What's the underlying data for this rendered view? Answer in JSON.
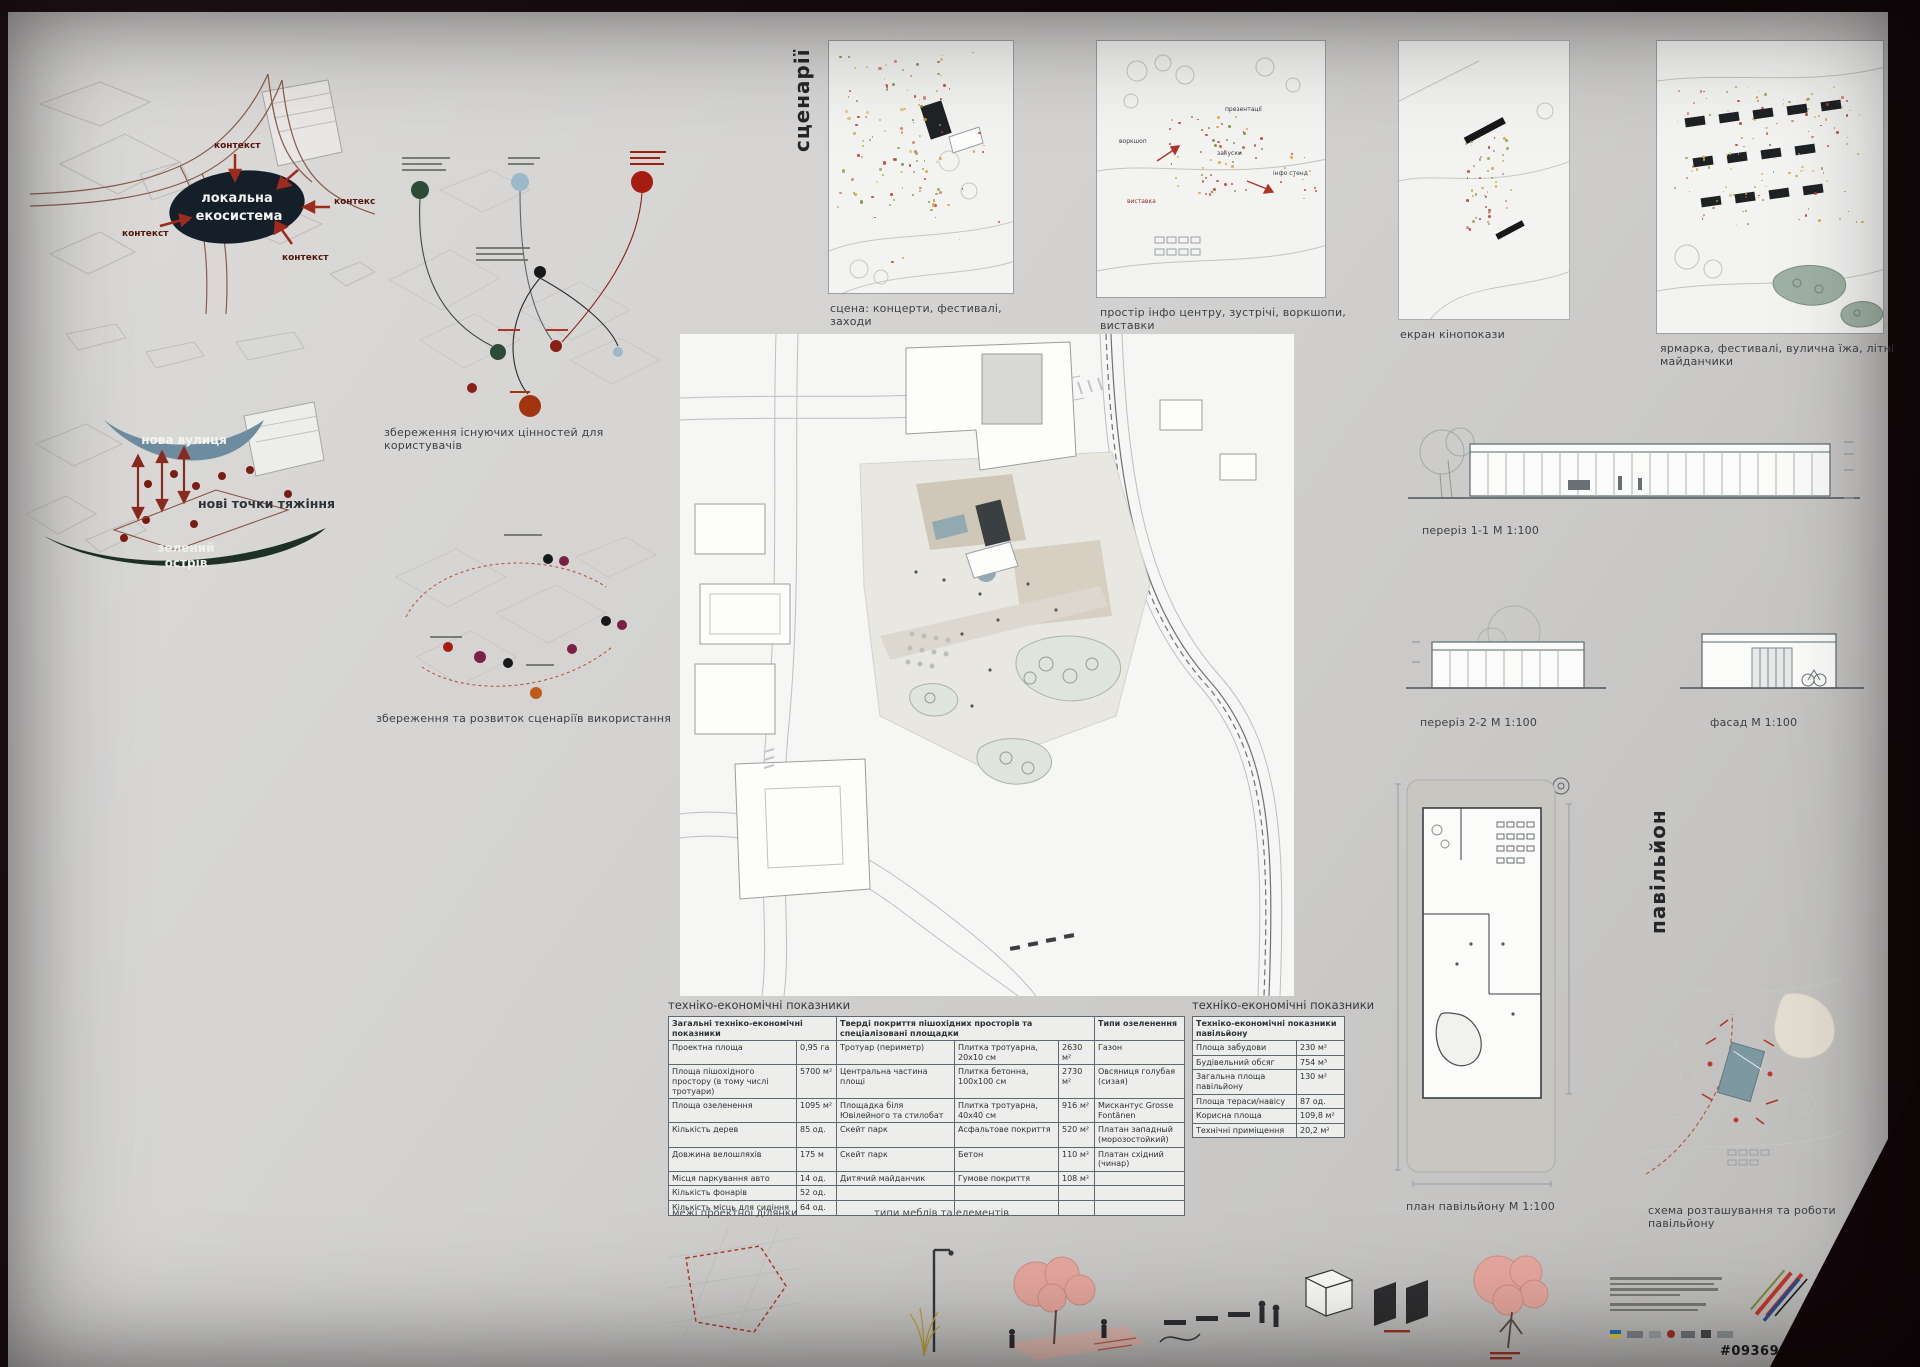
{
  "colors": {
    "accent_red": "#9e2b1e",
    "ink": "#2f363b",
    "new_street_blue": "#6e8ca0",
    "green_island": "#1e3126",
    "ecosystem_dark": "#151f29",
    "plaza_beige": "#cfc7b8",
    "pavilion_teal": "#7d98a0"
  },
  "diagrams": {
    "ecosystem": {
      "context": "контекст",
      "core_line1": "локальна",
      "core_line2": "екосистема"
    },
    "gravity": {
      "new_street": "нова вулиця",
      "new_points": "нові точки тяжіння",
      "green_line1": "зелений",
      "green_line2": "острів"
    },
    "values_caption": "збереження існуючих цінностей для користувачів",
    "usage_caption": "збереження та розвиток сценаріїв використання"
  },
  "scenarios": {
    "vertical_title": "сценарії",
    "panels": [
      {
        "caption": "сцена: концерти, фестивалі, заходи"
      },
      {
        "caption": "простір інфо центру, зустрічі, воркшопи, виставки",
        "labels": [
          "воркшоп",
          "презентації",
          "закуски",
          "інфо стенд",
          "виставка"
        ]
      },
      {
        "caption": "екран кінопокази"
      },
      {
        "caption": "ярмарка, фестивалі, вулична їжа, літні майданчики"
      }
    ]
  },
  "drawings": {
    "section11": "переріз 1-1 М 1:100",
    "section22": "переріз 2-2 М 1:100",
    "facade": "фасад М 1:100",
    "pavilion_vertical_title": "павільйон",
    "pavilion_plan": "план павільйону М 1:100",
    "pavilion_scheme": "схема розташування та роботи павільйону"
  },
  "tables": {
    "main": {
      "title": "техніко-економічні показники",
      "group1": "Загальні техніко-економічні показники",
      "group2": "Тверді покриття пішохідних просторів та спеціалізовані площадки",
      "group3": "Типи озеленення",
      "rows": [
        [
          "Проектна площа",
          "0,95 га",
          "Тротуар (периметр)",
          "Плитка тротуарна, 20х10 см",
          "2630 м²",
          "Газон"
        ],
        [
          "Площа пішохідного простору (в тому числі тротуари)",
          "5700 м²",
          "Центральна частина площі",
          "Плитка бетонна, 100х100 см",
          "2730 м²",
          "Овсяниця голубая (сизая)"
        ],
        [
          "Площа озеленення",
          "1095 м²",
          "Площадка біля Ювілейного та стилобат",
          "Плитка тротуарна, 40х40 см",
          "916 м²",
          "Мискантус Grosse Fontänen"
        ],
        [
          "Кількість дерев",
          "85 од.",
          "Скейт парк",
          "Асфальтове покриття",
          "520 м²",
          "Платан западный (морозостойкий)"
        ],
        [
          "Довжина велошляхів",
          "175 м",
          "Скейт парк",
          "Бетон",
          "110 м²",
          "Платан східний (чинар)"
        ],
        [
          "Місця паркування авто",
          "14 од.",
          "Дитячий майданчик",
          "Гумове покриття",
          "108 м²",
          ""
        ],
        [
          "Кількість фонарів",
          "52 од.",
          "",
          "",
          "",
          ""
        ],
        [
          "Кількість місць для сидіння",
          "64 од.",
          "",
          "",
          "",
          ""
        ]
      ]
    },
    "pavilion": {
      "title": "техніко-економічні показники",
      "header": "Техніко-економічні показники павільйону",
      "rows": [
        [
          "Площа забудови",
          "230 м²"
        ],
        [
          "Будівельний обсяг",
          "754 м³"
        ],
        [
          "Загальна площа павільйону",
          "130 м²"
        ],
        [
          "Площа тераси/навісу",
          "87 од."
        ],
        [
          "Корисна площа",
          "109,8 м²"
        ],
        [
          "Технічні приміщення",
          "20,2 м²"
        ]
      ]
    }
  },
  "legend": {
    "boundary": "межі проектної ділянки",
    "furniture": "типи меблів та елементів"
  },
  "footer": {
    "entry_code": "#093690"
  }
}
